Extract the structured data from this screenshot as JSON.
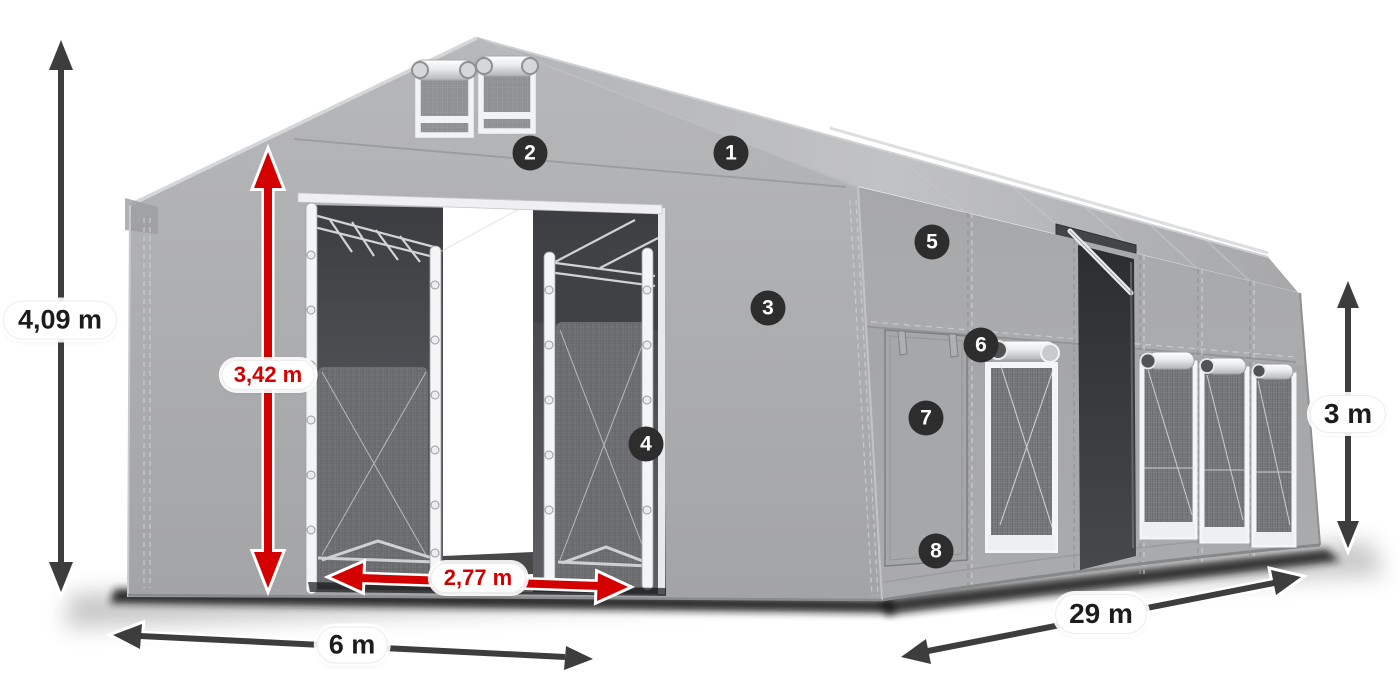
{
  "dimensions": [
    {
      "id": "total-height",
      "label": "4,09 m",
      "style": "dark"
    },
    {
      "id": "door-height",
      "label": "3,42 m",
      "style": "red"
    },
    {
      "id": "door-width",
      "label": "2,77 m",
      "style": "red"
    },
    {
      "id": "gable-width",
      "label": "6 m",
      "style": "dark"
    },
    {
      "id": "length",
      "label": "29 m",
      "style": "dark"
    },
    {
      "id": "side-height",
      "label": "3 m",
      "style": "dark"
    }
  ],
  "markers": [
    {
      "label": "1"
    },
    {
      "label": "2"
    },
    {
      "label": "3"
    },
    {
      "label": "4"
    },
    {
      "label": "5"
    },
    {
      "label": "6"
    },
    {
      "label": "7"
    },
    {
      "label": "8"
    }
  ],
  "colors": {
    "dimension-red": "#d40000",
    "dimension-dark": "#3d3d3d",
    "badge-bg": "#2d2d2d",
    "badge-text": "#ffffff",
    "label-text": "#1c1c1c",
    "fabric-gray": "#a8a9ab"
  }
}
